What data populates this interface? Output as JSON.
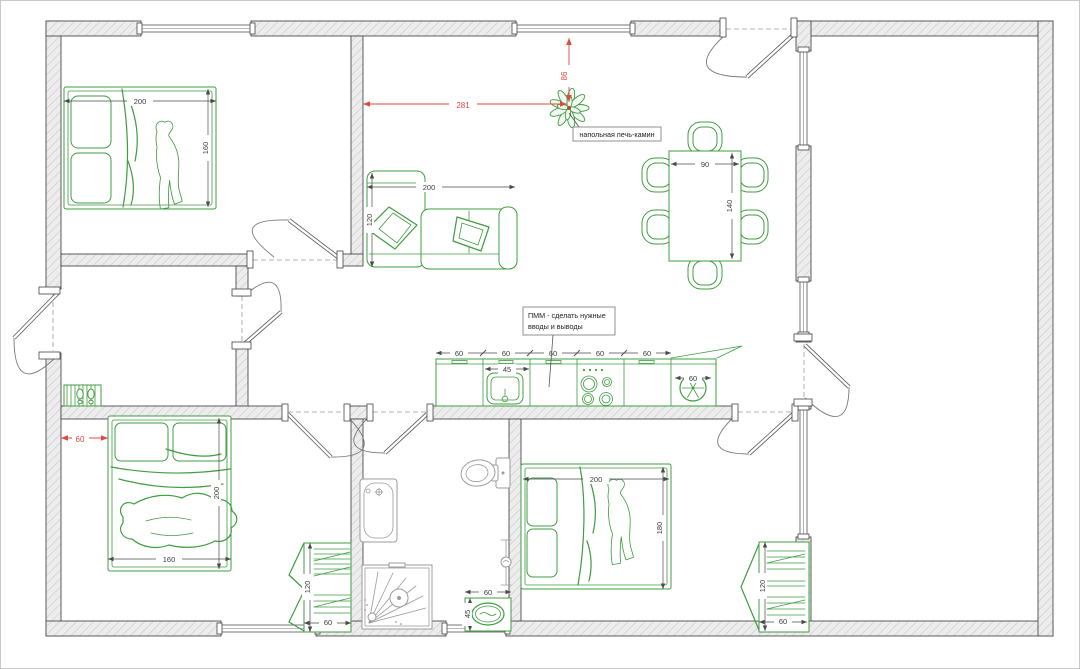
{
  "plan": {
    "annotations": {
      "stove_label": "напольная печь-камин",
      "dishwasher_note_line1": "ПММ - сделать нужные",
      "dishwasher_note_line2": "вводы и выводы"
    },
    "red_dims": {
      "stove_offset_horizontal": "281",
      "stove_offset_vertical": "86",
      "bed2_wall_offset": "60"
    },
    "furniture_dims": {
      "bed1_width": "200",
      "bed1_depth": "160",
      "sofa_width": "200",
      "sofa_depth": "120",
      "dining_table_width": "90",
      "dining_table_length": "140",
      "kitchen_units": [
        "60",
        "60",
        "60",
        "60",
        "60"
      ],
      "kitchen_sink_width": "45",
      "fridge_width": "60",
      "bed2_width": "160",
      "bed2_length": "200",
      "bed3_width": "200",
      "bed3_depth": "180",
      "wardrobe_bedroom2_height": "120",
      "wardrobe_bedroom2_width": "60",
      "wardrobe_bedroom3_height": "120",
      "wardrobe_bedroom3_width": "60",
      "bath_sink_width": "60",
      "bath_sink_depth": "45"
    },
    "colors": {
      "furniture_green": "#3f9c40",
      "dimension_red": "#dd4a42",
      "wall_outline": "#4c4c4c",
      "wall_fill": "#ededed",
      "wall_hatch": "#c9c9c9",
      "fixture_gray": "#9b9b9b",
      "dim_text": "#3c3c3c"
    }
  }
}
